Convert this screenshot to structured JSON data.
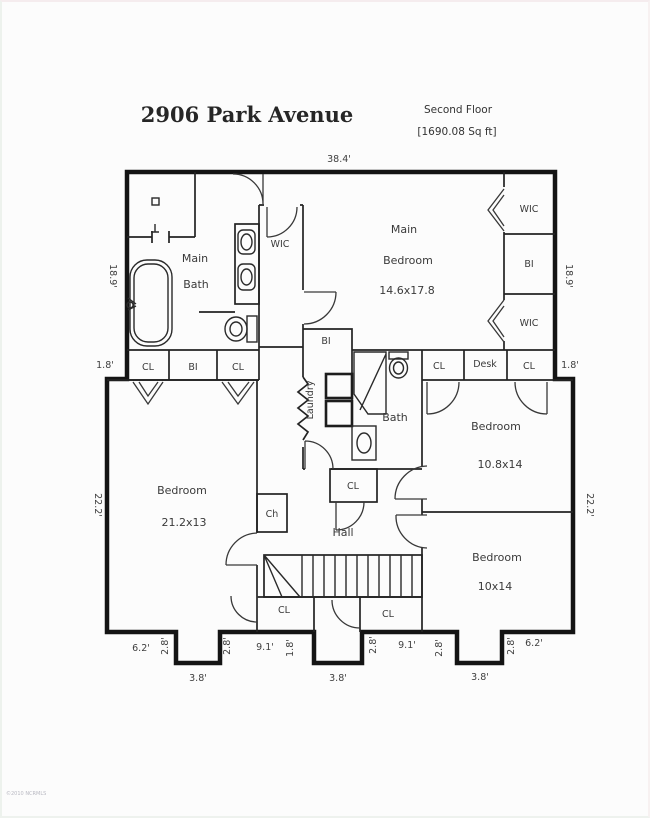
{
  "header": {
    "title": "2906 Park Avenue",
    "floor": "Second Floor",
    "area": "[1690.08 Sq ft]"
  },
  "watermark": "©2010 NCRMLS",
  "rooms": {
    "main_bath": {
      "line1": "Main",
      "line2": "Bath"
    },
    "wic_center": {
      "label": "WIC"
    },
    "main_bedroom": {
      "line1": "Main",
      "line2": "Bedroom",
      "dims": "14.6x17.8"
    },
    "closet_right_top": {
      "label": "WIC"
    },
    "closet_right_mid": {
      "label": "BI"
    },
    "closet_right_bottom": {
      "label": "WIC"
    },
    "band_left": {
      "cl1": "CL",
      "bi": "BI",
      "cl2": "CL"
    },
    "bi_center": {
      "label": "BI"
    },
    "laundry": {
      "label": "Laundry"
    },
    "bath": {
      "label": "Bath"
    },
    "cl_mid": {
      "label": "CL"
    },
    "band_right": {
      "cl1": "CL",
      "desk": "Desk",
      "cl2": "CL"
    },
    "bedroom_left": {
      "line1": "Bedroom",
      "dims": "21.2x13"
    },
    "chase": {
      "label": "Ch"
    },
    "hall": {
      "label": "Hall"
    },
    "bedroom_right_top": {
      "line1": "Bedroom",
      "dims": "10.8x14"
    },
    "bedroom_right_bottom": {
      "line1": "Bedroom",
      "dims": "10x14"
    },
    "cl_bottom_left": {
      "label": "CL"
    },
    "cl_bottom_right": {
      "label": "CL"
    }
  },
  "dimensions": {
    "top": "38.4'",
    "left_upper": "18.9'",
    "left_jog": "1.8'",
    "left_lower": "22.2'",
    "right_upper": "18.9'",
    "right_jog": "1.8'",
    "right_lower": "22.2'",
    "bottom": [
      "6.2'",
      "2.8'",
      "3.8'",
      "2.8'",
      "9.1'",
      "1.8'",
      "3.8'",
      "2.8'",
      "9.1'",
      "2.8'",
      "3.8'",
      "2.8'",
      "6.2'"
    ]
  },
  "colors": {
    "wall": "#141414",
    "text": "#3a3a3a"
  }
}
